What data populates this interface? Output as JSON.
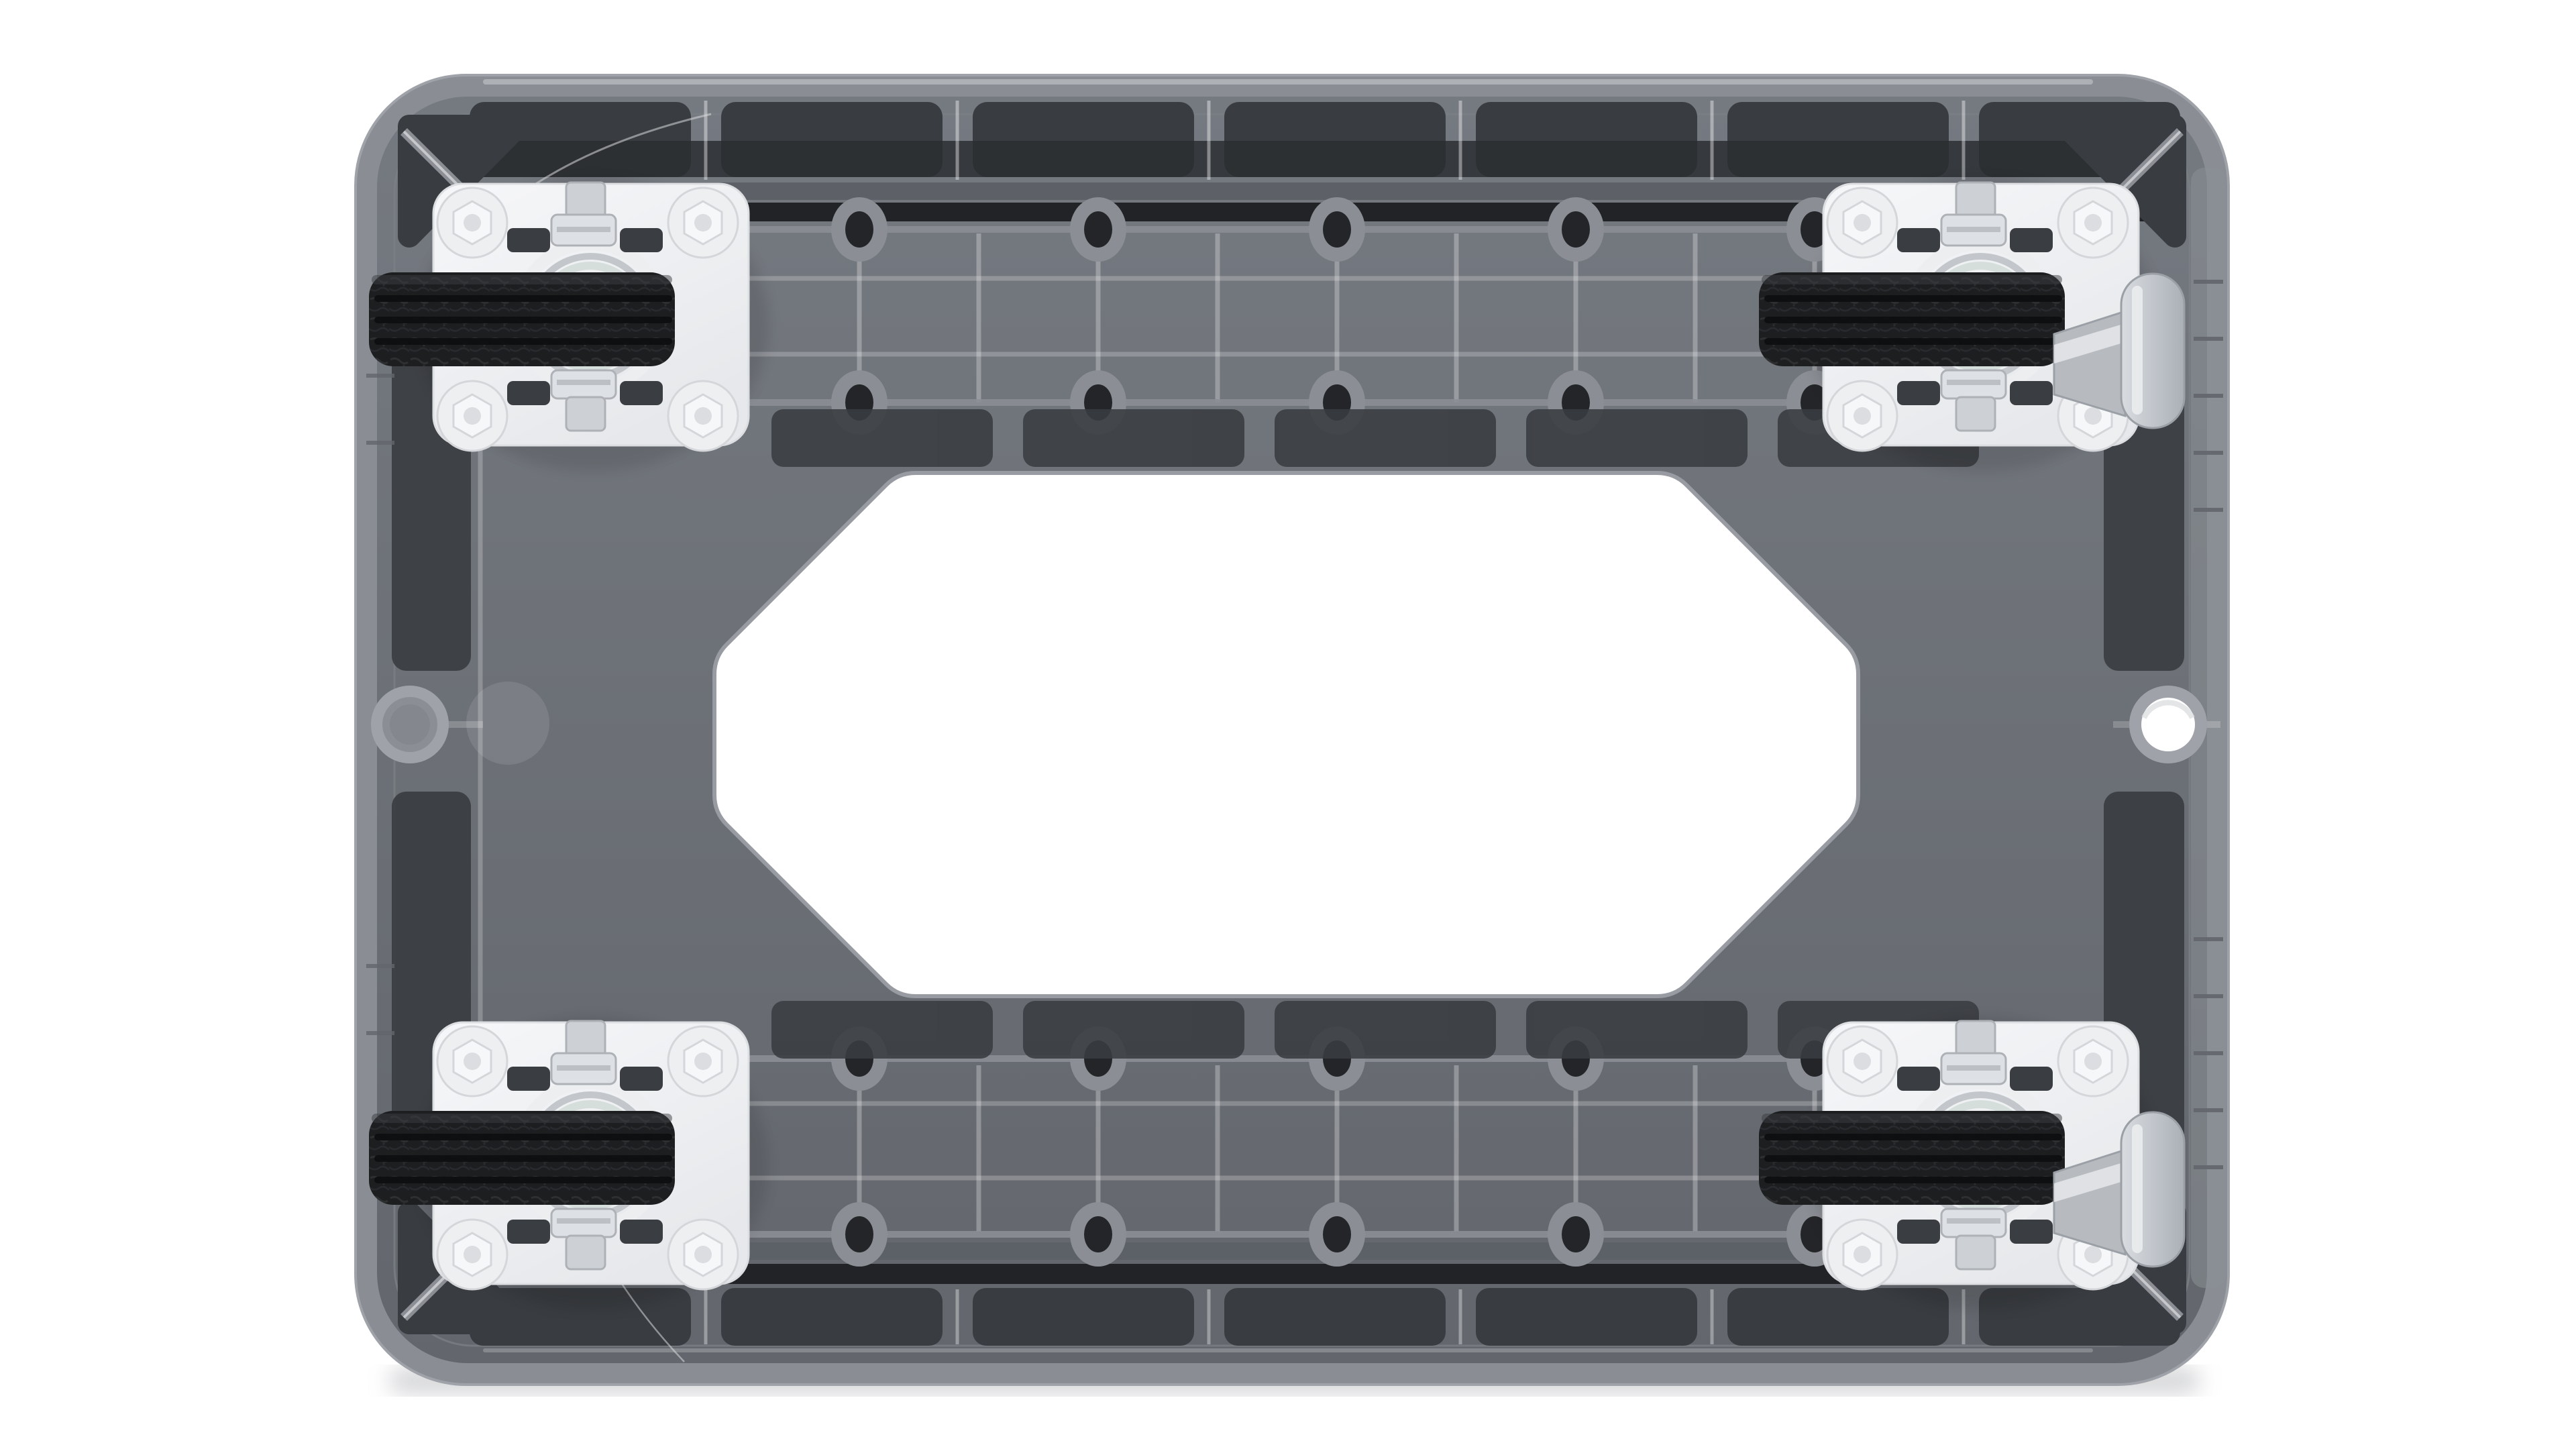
{
  "scene": {
    "description": "Bottom view of a grey plastic platform dolly: ribbed grey deck with dark recessed panels, a large white octagonal cutout in the centre, four black rubber swivel casters bolted to white square mounting plates at the corners, silver brake pedals on the two right-hand casters, a round moulded boss on the left edge and a circular through-hole on the right edge, on a white background."
  },
  "colors": {
    "bg": "#ffffff",
    "edge": "#8a8e94",
    "edgeHi": "#9fa3a9",
    "bodyHi": "#757980",
    "bodyLo": "#63676d",
    "lip": "#7b7f85",
    "panel": "#393c40",
    "panel2": "#2c2e31",
    "stripeL": "#5c6066",
    "stripeD": "#212326",
    "ribHi": "#ffffff",
    "bossRing": "#8b8f95",
    "hole": "#232528",
    "octRim": "#989ca2",
    "plateA": "#f6f7f9",
    "plateB": "#e6e8eb",
    "plateEdge": "#dcdee1",
    "bolt": "#edeff1",
    "boltEdge": "#d4d6d9",
    "tire": "#1d1e20",
    "tireHi": "#3a3c40",
    "groove": "#0c0d0e",
    "metalL": "#eceef0",
    "metalM": "#c3c7cb",
    "metalG": "#d6dedb",
    "metalD": "#b0b4b9",
    "nutA": "#dde0e4",
    "nutB": "#cdd1d6",
    "nutEdge": "#aeb2b7",
    "hub": "#3a3d41",
    "pedalA": "#d9dce0",
    "pedalB": "#aab0b6",
    "pedalStem": "#b7bbc0",
    "pedalEdge": "#9aa0a6",
    "shadow": "#b9bbbe",
    "hairline": "#d8dadd",
    "ghost": "#84888e"
  },
  "parts": {
    "body": "dolly body",
    "cutout": "central octagonal cutout",
    "left_boss": "round moulded boss",
    "right_hole": "circular through-hole",
    "casters": [
      "top-left caster",
      "top-right caster",
      "bottom-left caster",
      "bottom-right caster"
    ],
    "brake_pedals": [
      "top-right brake pedal",
      "bottom-right brake pedal"
    ]
  }
}
